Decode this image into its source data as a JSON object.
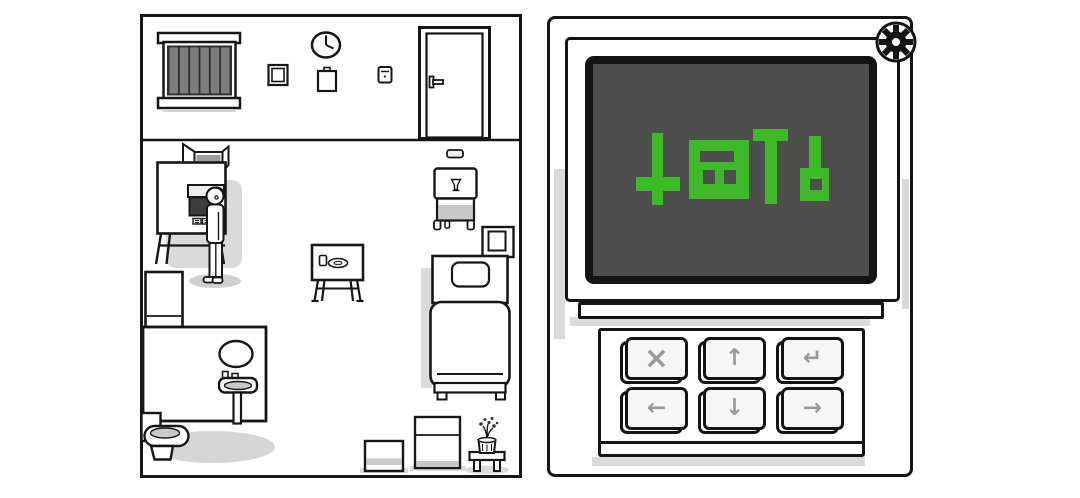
{
  "scene": {
    "style": "hand-drawn black-and-white escape room game",
    "left_panel": "patient room overview",
    "right_panel": "terminal with symbol screen and keypad"
  },
  "colors": {
    "outline": "#161616",
    "background": "#ffffff",
    "shadow": "#dadada",
    "screen_background": "#4e4e4c",
    "symbol_green": "#3eba28",
    "key_symbol_gray": "#9a9a9a"
  },
  "room": {
    "objects": [
      "window-blinds",
      "wall-clock",
      "small-picture-frame",
      "wall-notepad",
      "light-switch",
      "door",
      "wall-sign",
      "serving-cart",
      "picture-frame",
      "bed",
      "delivery-machine",
      "character",
      "white-cabinet",
      "bathroom-wall",
      "mirror",
      "sink",
      "toilet",
      "tray-table",
      "suitcase-small",
      "suitcase-large",
      "plant-stool",
      "potted-plant"
    ]
  },
  "terminal": {
    "gear_icon": "gear",
    "keys": [
      {
        "name": "cancel",
        "symbol": "×"
      },
      {
        "name": "up",
        "symbol": "↑"
      },
      {
        "name": "enter",
        "symbol": "↵"
      },
      {
        "name": "left",
        "symbol": "←"
      },
      {
        "name": "down",
        "symbol": "↓"
      },
      {
        "name": "right",
        "symbol": "→"
      }
    ],
    "screen": {
      "background": "#4e4e4c",
      "symbol_color": "#3eba28",
      "glyphs": [
        {
          "name": "inverted-cross",
          "fill": [
            [
              58,
              66,
              11,
              72
            ],
            [
              42,
              110,
              44,
              14
            ]
          ],
          "holes": []
        },
        {
          "name": "slotted-square",
          "fill": [
            [
              95,
              73,
              60,
              59
            ]
          ],
          "holes": [
            [
              106,
              84,
              34,
              11
            ],
            [
              109,
              103,
              12,
              14
            ],
            [
              130,
              103,
              12,
              14
            ]
          ]
        },
        {
          "name": "t-shape",
          "fill": [
            [
              159,
              62,
              35,
              12
            ],
            [
              171,
              62,
              12,
              75
            ]
          ],
          "holes": []
        },
        {
          "name": "flag",
          "fill": [
            [
              215,
              69,
              12,
              33
            ],
            [
              206,
              101,
              29,
              33
            ]
          ],
          "holes": [
            [
              216,
              112,
              12,
              11
            ]
          ]
        }
      ]
    }
  }
}
